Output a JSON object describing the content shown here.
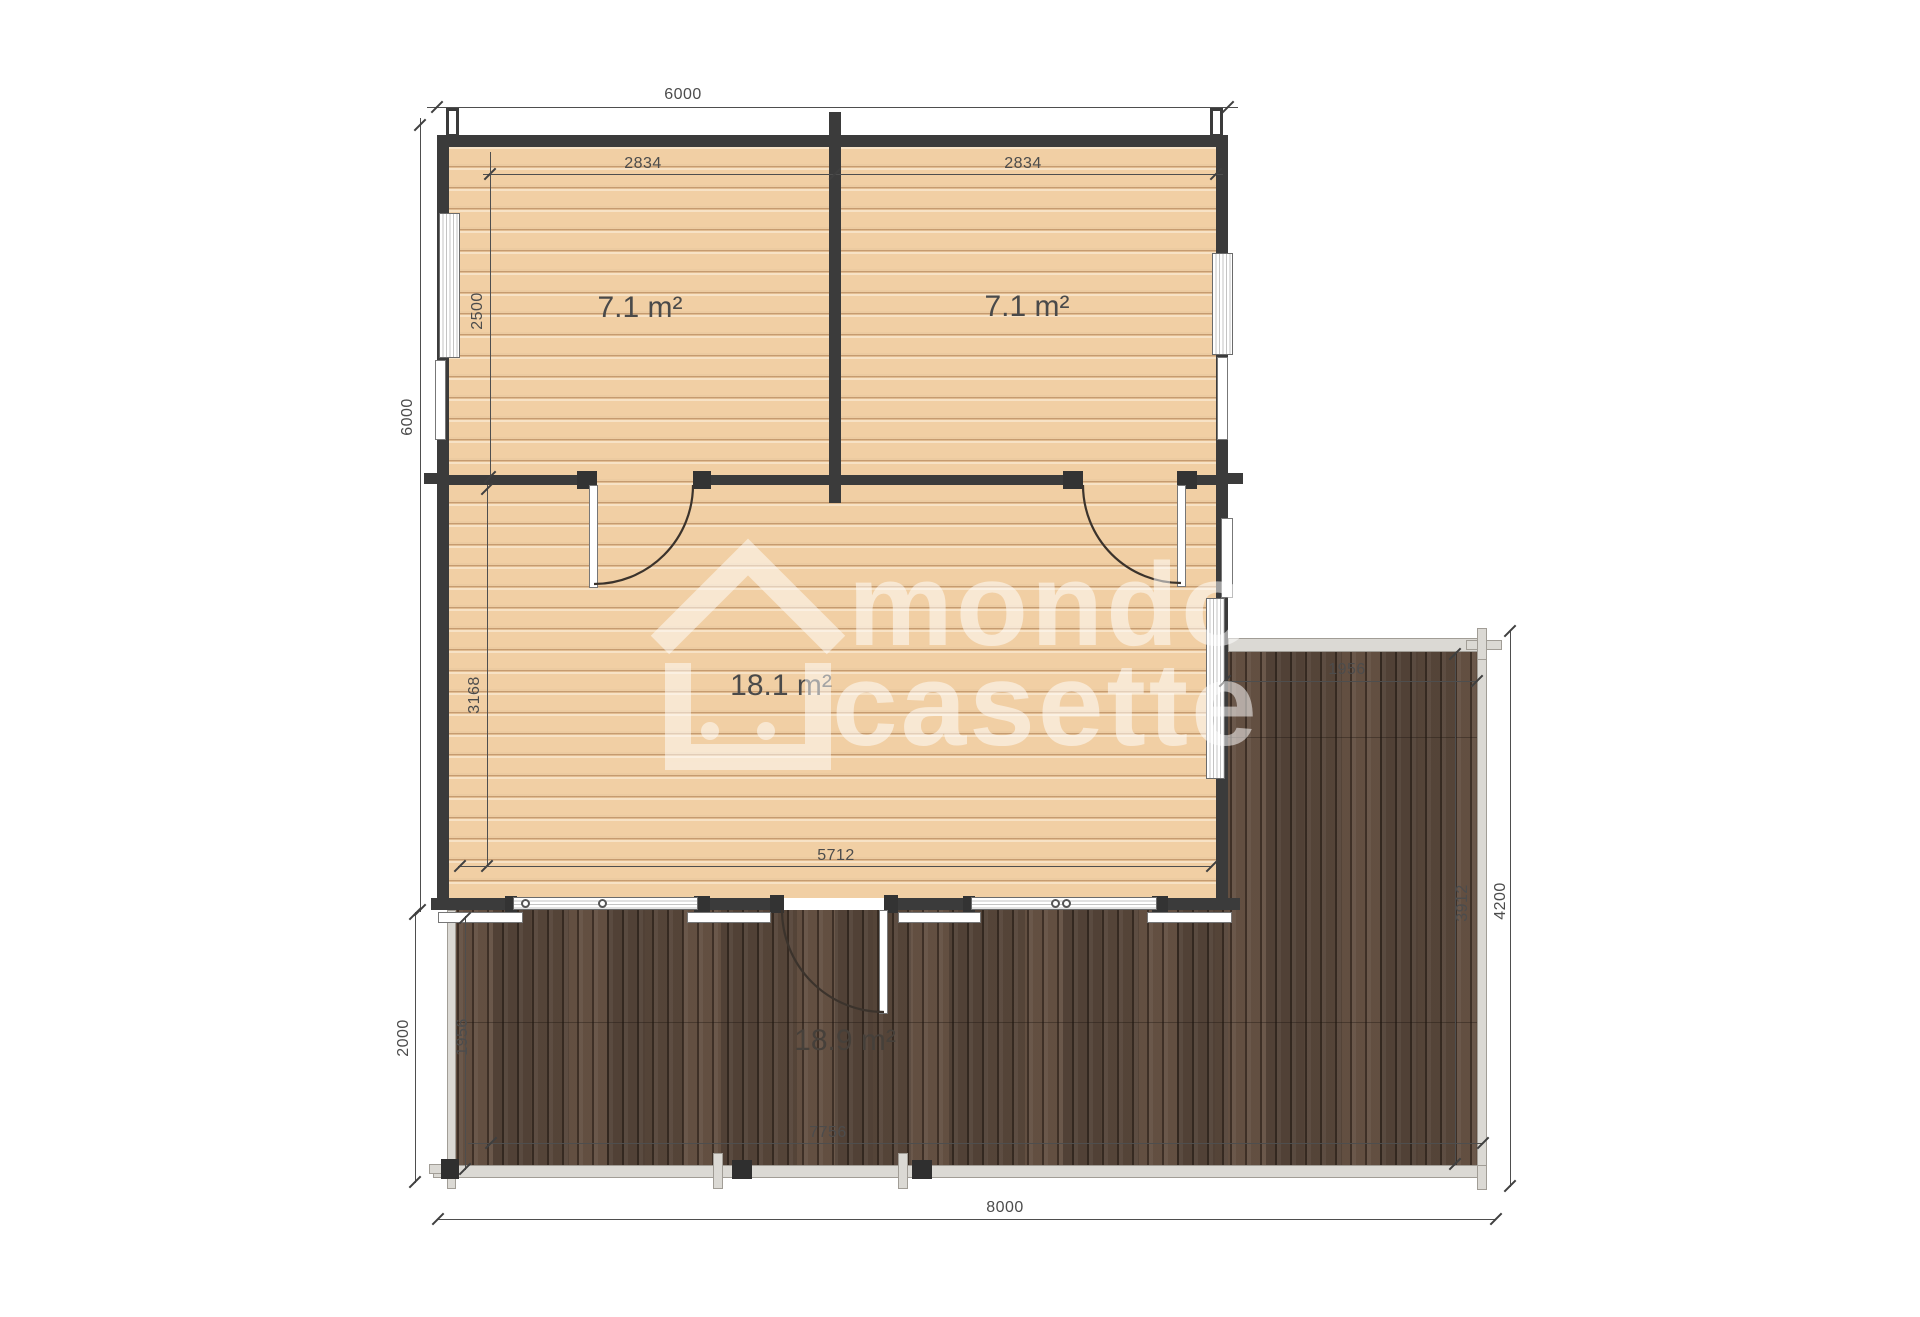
{
  "watermark": {
    "word1": "mondo",
    "word2": "casette"
  },
  "areas": {
    "room_top_left": "7.1 m²",
    "room_top_right": "7.1 m²",
    "room_main": "18.1 m²",
    "terrace_front": "18.9 m²"
  },
  "dims": {
    "top_width": "6000",
    "left_height": "6000",
    "room_tl_width": "2834",
    "room_tr_width": "2834",
    "room_tl_height": "2500",
    "main_room_height": "3168",
    "main_room_width": "5712",
    "terrace_right_width": "1956",
    "terrace_right_length": "3912",
    "terrace_right_total": "4200",
    "terrace_front_depth_inner": "1956",
    "terrace_front_depth": "2000",
    "terrace_front_width_inner": "7756",
    "total_width": "8000"
  },
  "colors": {
    "wall": "#3b3b3b",
    "floor": "#f1cfa4",
    "deck": "#5c4a3e",
    "rim": "#dbd9d4",
    "dimension_text": "#4c4c4c"
  }
}
